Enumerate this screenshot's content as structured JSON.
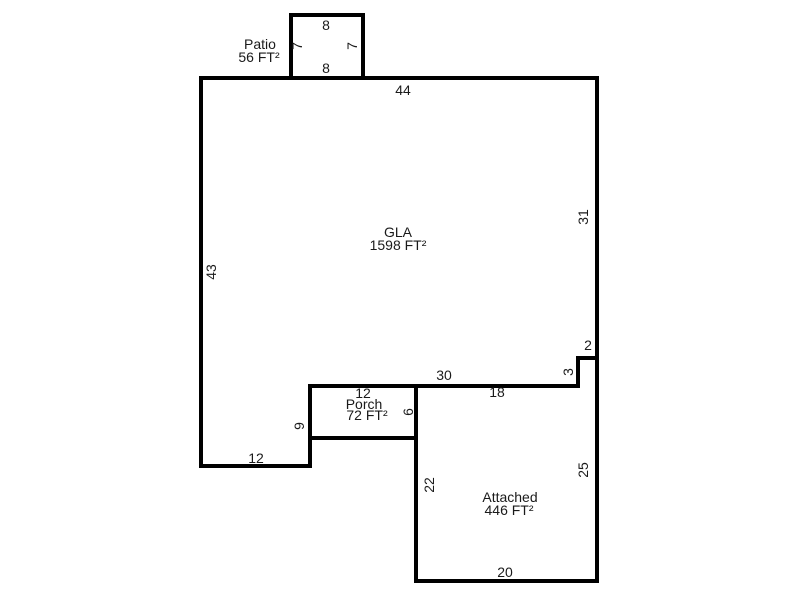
{
  "sketch": {
    "areas": {
      "gla": {
        "name": "GLA",
        "area": "1598 FT²"
      },
      "patio": {
        "name": "Patio",
        "area": "56 FT²"
      },
      "porch": {
        "name": "Porch",
        "area": "72 FT²"
      },
      "attached": {
        "name": "Attached",
        "area": "446 FT²"
      }
    },
    "dims": {
      "patio_top": "8",
      "patio_left": "7",
      "patio_right": "7",
      "patio_bottom": "8",
      "gla_top": "44",
      "gla_right": "31",
      "gla_left": "43",
      "gla_bottom_left": "12",
      "step_width": "2",
      "step_height": "3",
      "rear_span": "30",
      "attached_top": "18",
      "porch_top": "12",
      "porch_right": "6",
      "notch_height": "9",
      "attached_left": "22",
      "attached_right": "25",
      "attached_bottom": "20"
    },
    "colors": {
      "wall": "#000000",
      "text": "#1a1a1a",
      "background": "#ffffff"
    }
  }
}
